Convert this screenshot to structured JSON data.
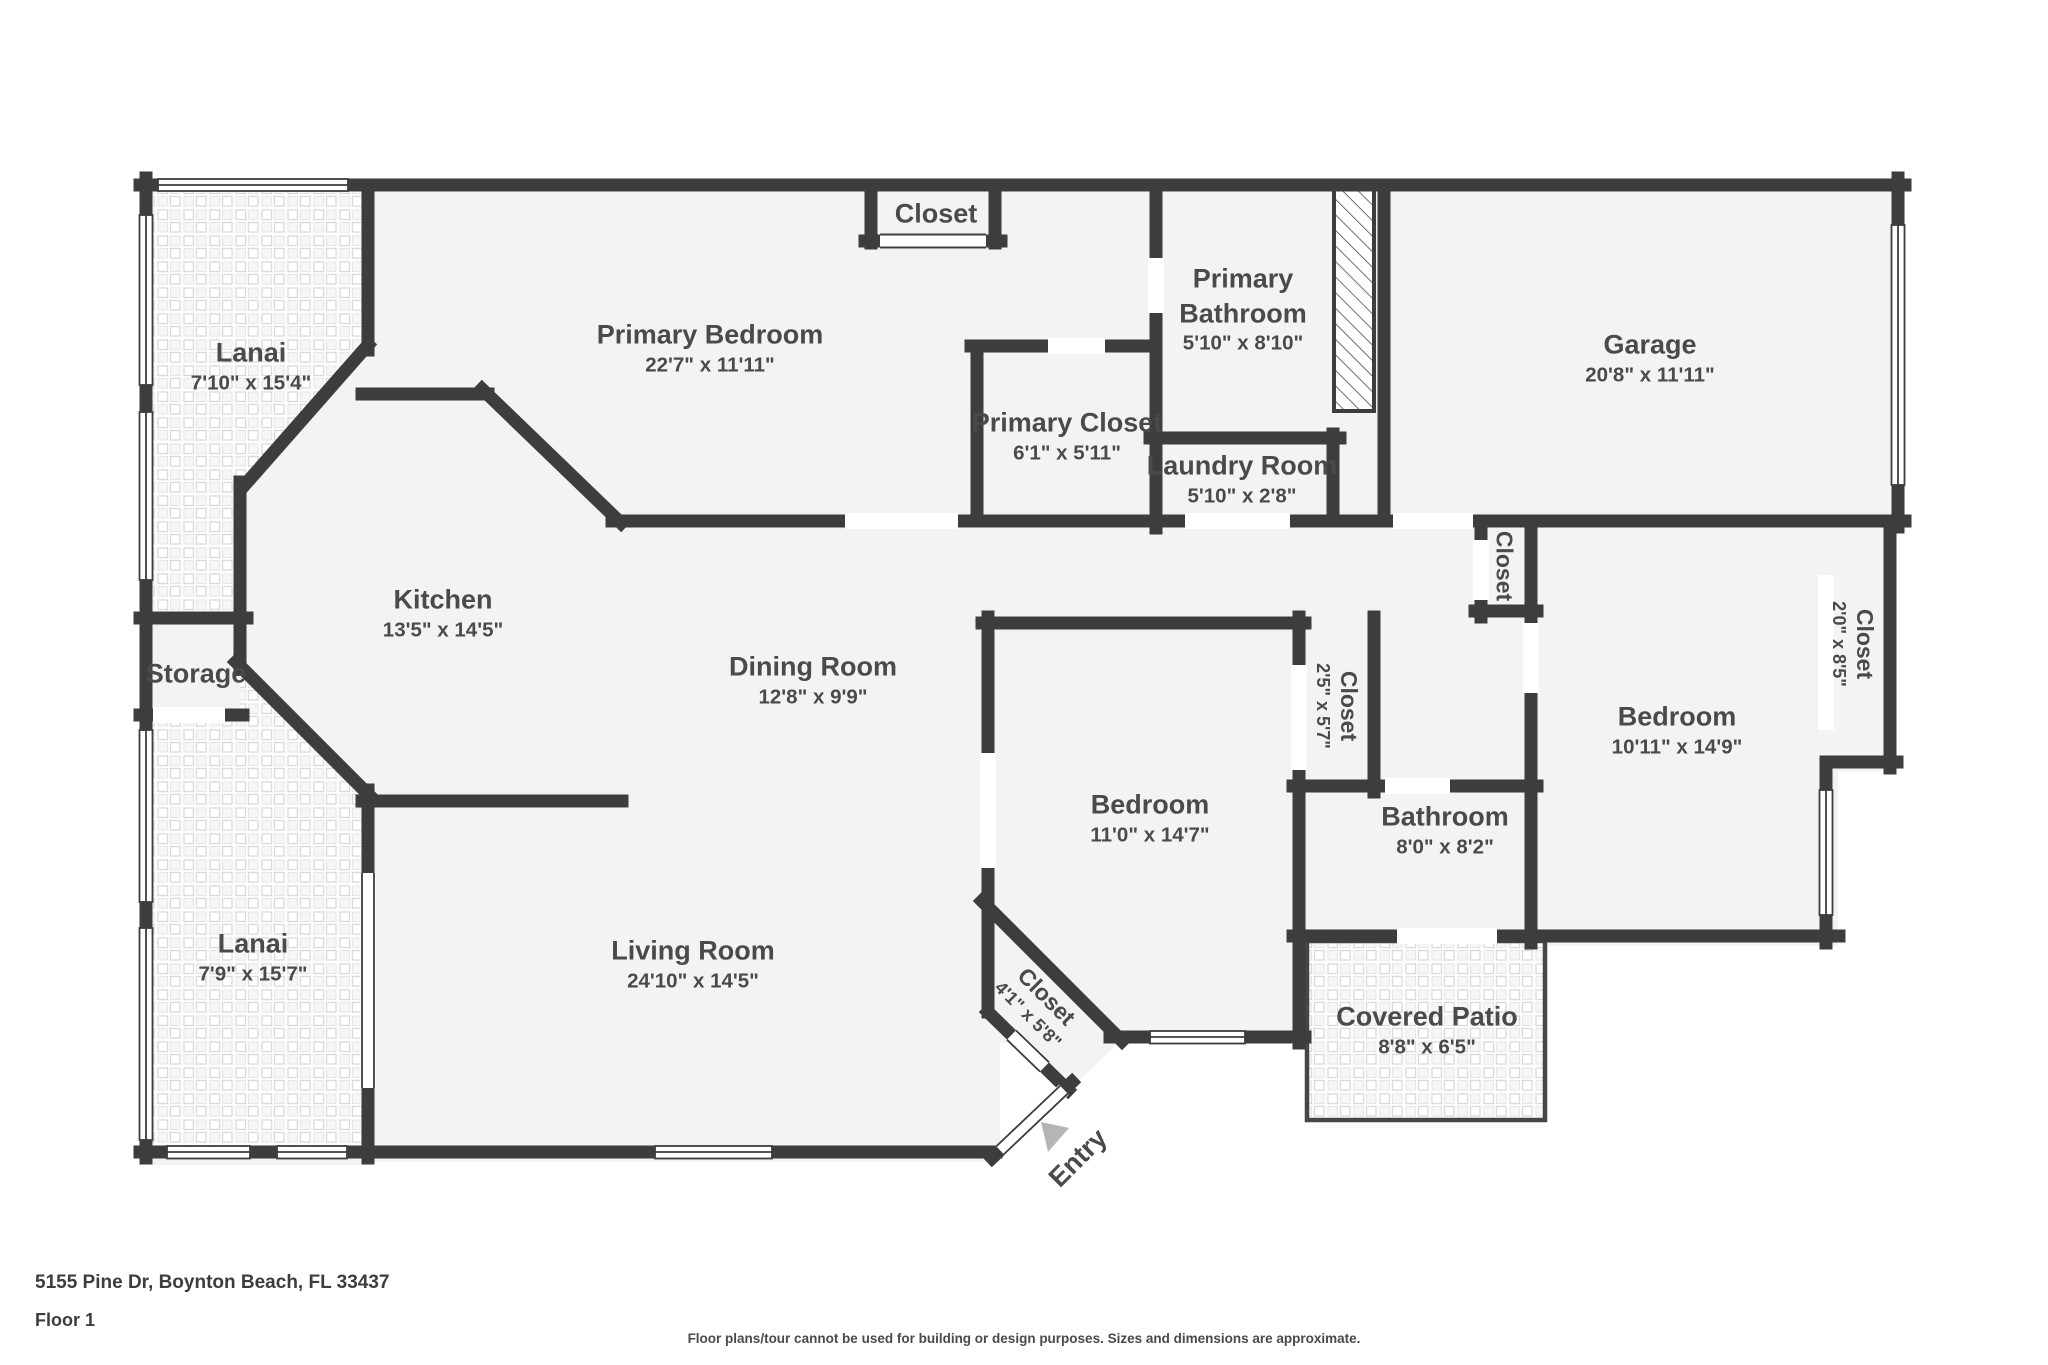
{
  "colors": {
    "wall": "#3d3d40",
    "floor": "#f3f3f4",
    "text": "#4a4a4c",
    "tile_line": "#d9d9d9",
    "arrow": "#b5b5b5"
  },
  "rooms": {
    "lanai1": {
      "name": "Lanai",
      "dims": "7'10\" x 15'4\""
    },
    "primary_bedroom": {
      "name": "Primary Bedroom",
      "dims": "22'7\" x 11'11\""
    },
    "closet_top": {
      "name": "Closet",
      "dims": ""
    },
    "primary_bathroom": {
      "name": "Primary Bathroom",
      "dims": "5'10\" x 8'10\""
    },
    "garage": {
      "name": "Garage",
      "dims": "20'8\" x 11'11\""
    },
    "primary_closet": {
      "name": "Primary Closet",
      "dims": "6'1\" x 5'11\""
    },
    "laundry": {
      "name": "Laundry Room",
      "dims": "5'10\" x 2'8\""
    },
    "kitchen": {
      "name": "Kitchen",
      "dims": "13'5\" x 14'5\""
    },
    "storage": {
      "name": "Storage",
      "dims": ""
    },
    "dining": {
      "name": "Dining Room",
      "dims": "12'8\" x 9'9\""
    },
    "hall_closet": {
      "name": "Closet",
      "dims": ""
    },
    "closet_small": {
      "name": "Closet",
      "dims": "2'5\" x 5'7\""
    },
    "bedroom_mid": {
      "name": "Bedroom",
      "dims": "11'0\" x 14'7\""
    },
    "bathroom": {
      "name": "Bathroom",
      "dims": "8'0\" x 8'2\""
    },
    "bedroom_right": {
      "name": "Bedroom",
      "dims": "10'11\" x 14'9\""
    },
    "closet_right": {
      "name": "Closet",
      "dims": "2'0\" x 8'5\""
    },
    "lanai2": {
      "name": "Lanai",
      "dims": "7'9\" x 15'7\""
    },
    "living": {
      "name": "Living Room",
      "dims": "24'10\" x 14'5\""
    },
    "closet_diag": {
      "name": "Closet",
      "dims": "4'1\" x 5'8\""
    },
    "covered_patio": {
      "name": "Covered Patio",
      "dims": "8'8\" x 6'5\""
    },
    "entry": {
      "name": "Entry",
      "dims": ""
    }
  },
  "footer": {
    "address": "5155 Pine Dr, Boynton Beach, FL 33437",
    "floor": "Floor 1",
    "disclaimer": "Floor plans/tour cannot be used for building or design purposes. Sizes and dimensions are approximate."
  }
}
